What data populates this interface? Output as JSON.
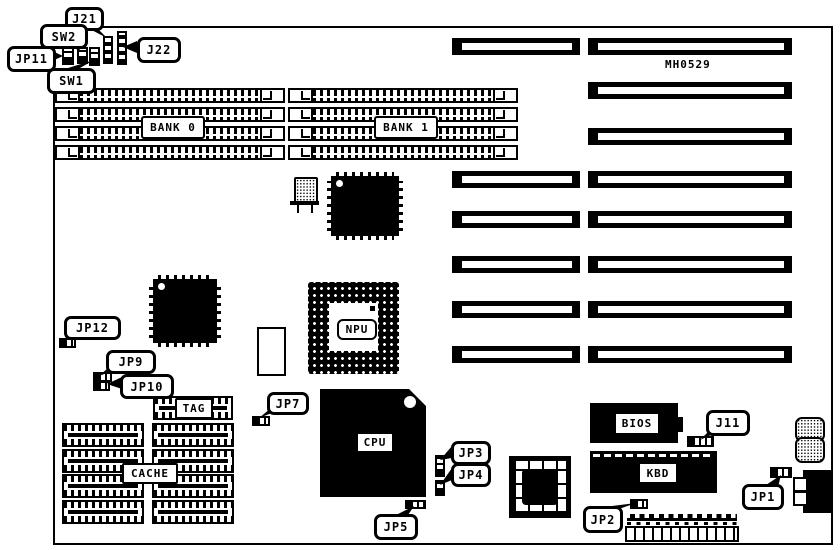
{
  "board": {
    "part_number": "MH0529"
  },
  "memory": {
    "bank0": "BANK 0",
    "bank1": "BANK 1"
  },
  "chips": {
    "npu": "NPU",
    "cpu": "CPU",
    "tag": "TAG",
    "cache": "CACHE",
    "bios": "BIOS",
    "kbd": "KBD"
  },
  "callouts": {
    "j21": "J21",
    "sw2": "SW2",
    "jp11": "JP11",
    "sw1": "SW1",
    "j22": "J22",
    "jp12": "JP12",
    "jp9": "JP9",
    "jp10": "JP10",
    "jp7": "JP7",
    "jp3": "JP3",
    "jp4": "JP4",
    "jp5": "JP5",
    "jp2": "JP2",
    "jp1": "JP1",
    "j11": "J11"
  }
}
